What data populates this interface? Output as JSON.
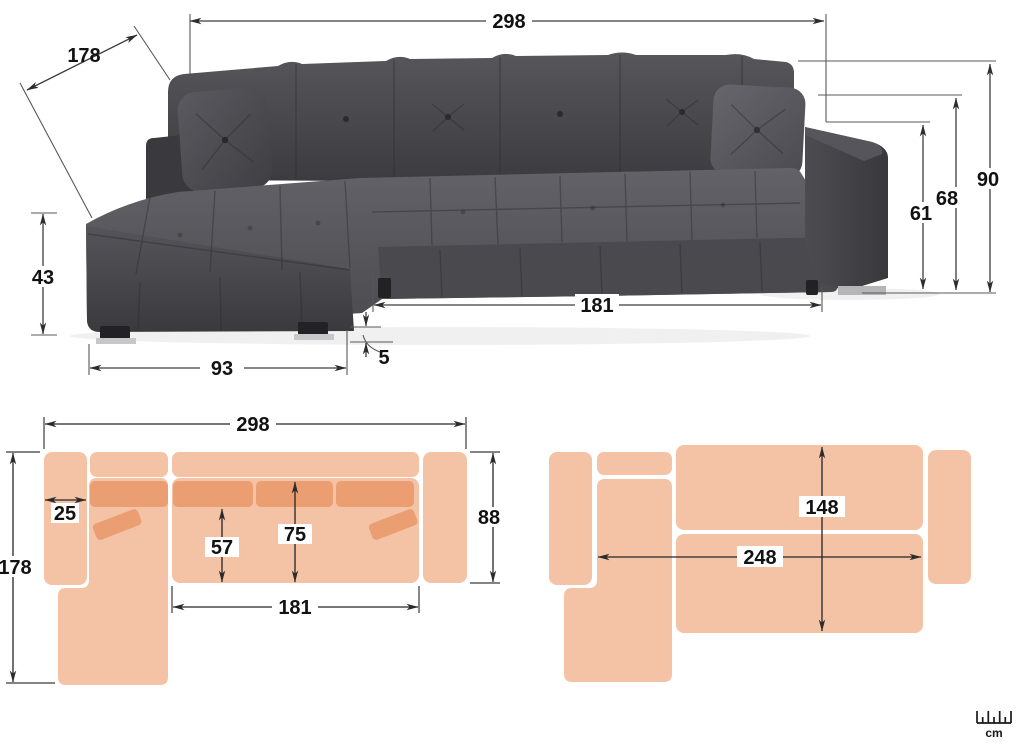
{
  "photo": {
    "total_width": "298",
    "total_depth": "178",
    "total_height": "90",
    "backrest_height": "68",
    "armrest_height": "61",
    "seat_height": "43",
    "chaise_front_width": "93",
    "leg_height": "5",
    "seat_width": "181"
  },
  "plan_top": {
    "total_width": "298",
    "armrest_width": "25",
    "total_depth": "178",
    "seat_depth": "57",
    "deck_depth": "75",
    "body_depth": "88",
    "seat_width": "181"
  },
  "plan_bed": {
    "bed_depth": "148",
    "bed_width": "248"
  },
  "unit": {
    "label": "cm",
    "icon": "ruler-icon"
  },
  "colors": {
    "plan_fill": "#f4c2a5",
    "plan_cushion": "#eb9e72",
    "sofa_dark": "#48484c",
    "dimension_line": "#3d3d3d",
    "background": "#ffffff"
  }
}
